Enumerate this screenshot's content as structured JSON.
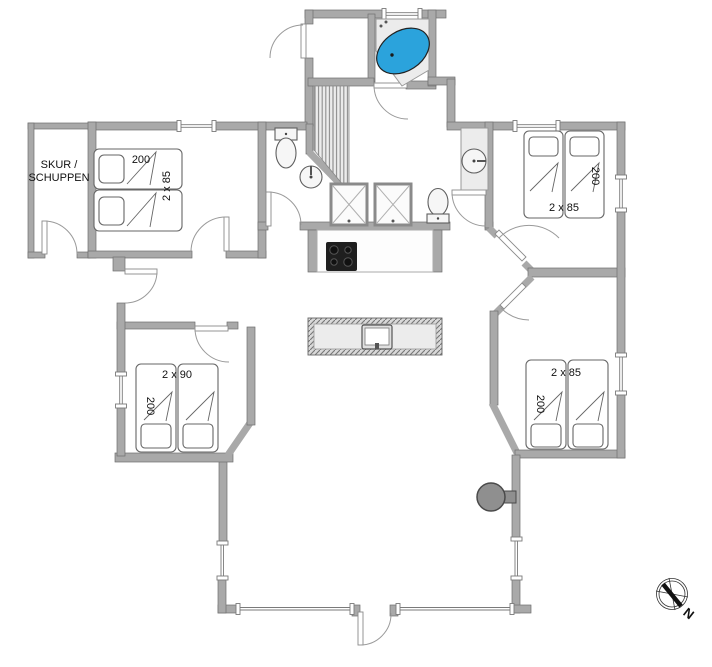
{
  "shed": {
    "label_line1": "SKUR /",
    "label_line2": "SCHUPPEN"
  },
  "beds": {
    "top_left": {
      "length": "200",
      "width": "2 x 85"
    },
    "top_right": {
      "length": "200",
      "width": "2 x 85"
    },
    "bottom_left": {
      "length": "200",
      "width": "2 x 90"
    },
    "bottom_right": {
      "length": "200",
      "width": "2 x 85"
    }
  },
  "compass": {
    "north": "N"
  },
  "colors": {
    "background": "#ffffff",
    "wall": "#a9a9a9",
    "wall_stroke": "#707070",
    "door_arc": "#9a9a9a",
    "tub": "#2ba3dc",
    "fixture": "#ececec",
    "cooktop": "#1f1f1f",
    "wood_stove": "#8f8f8f"
  }
}
